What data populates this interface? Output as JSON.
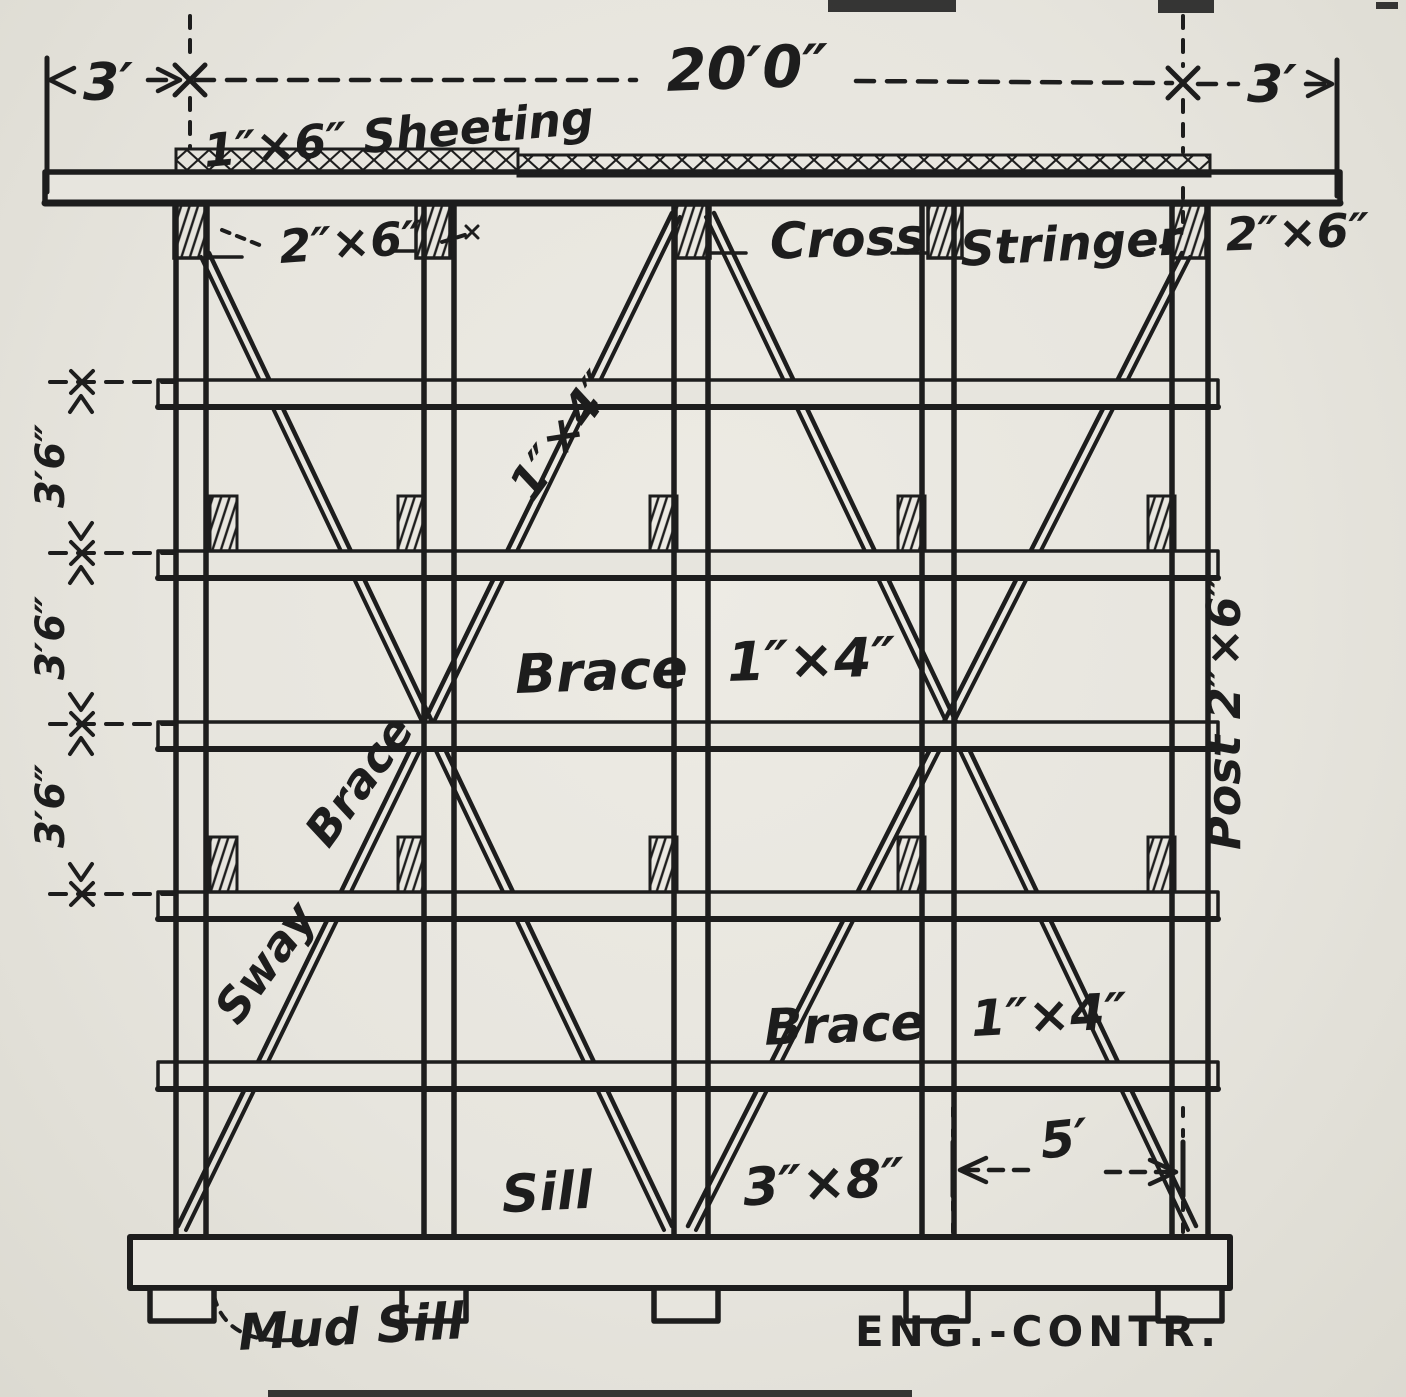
{
  "colors": {
    "paper": "#e7e5de",
    "ink": "#1d1d1d"
  },
  "dimensions": {
    "overhang_left": "3′",
    "span": "20′0″",
    "overhang_right": "3′",
    "tier_spacing": [
      "3′6″",
      "3′6″",
      "3′6″"
    ],
    "post_spacing": "5′"
  },
  "labels": {
    "sheeting": "1″×6″ Sheeting",
    "cap_size": "2″×6″",
    "cross": "Cross",
    "stringer": "Stringer",
    "stringer_size": "2″×6″",
    "diag_brace_size": "1″×4″",
    "brace": "Brace",
    "brace_size": "1″×4″",
    "sway": "Sway",
    "sway_brace": "Brace",
    "post": "Post 2″×6″",
    "brace_lower": "Brace",
    "brace_lower_size": "1″×4″",
    "sill": "Sill",
    "sill_size": "3″×8″",
    "mud_sill": "Mud Sill",
    "credit": "ENG.-CONTR."
  }
}
